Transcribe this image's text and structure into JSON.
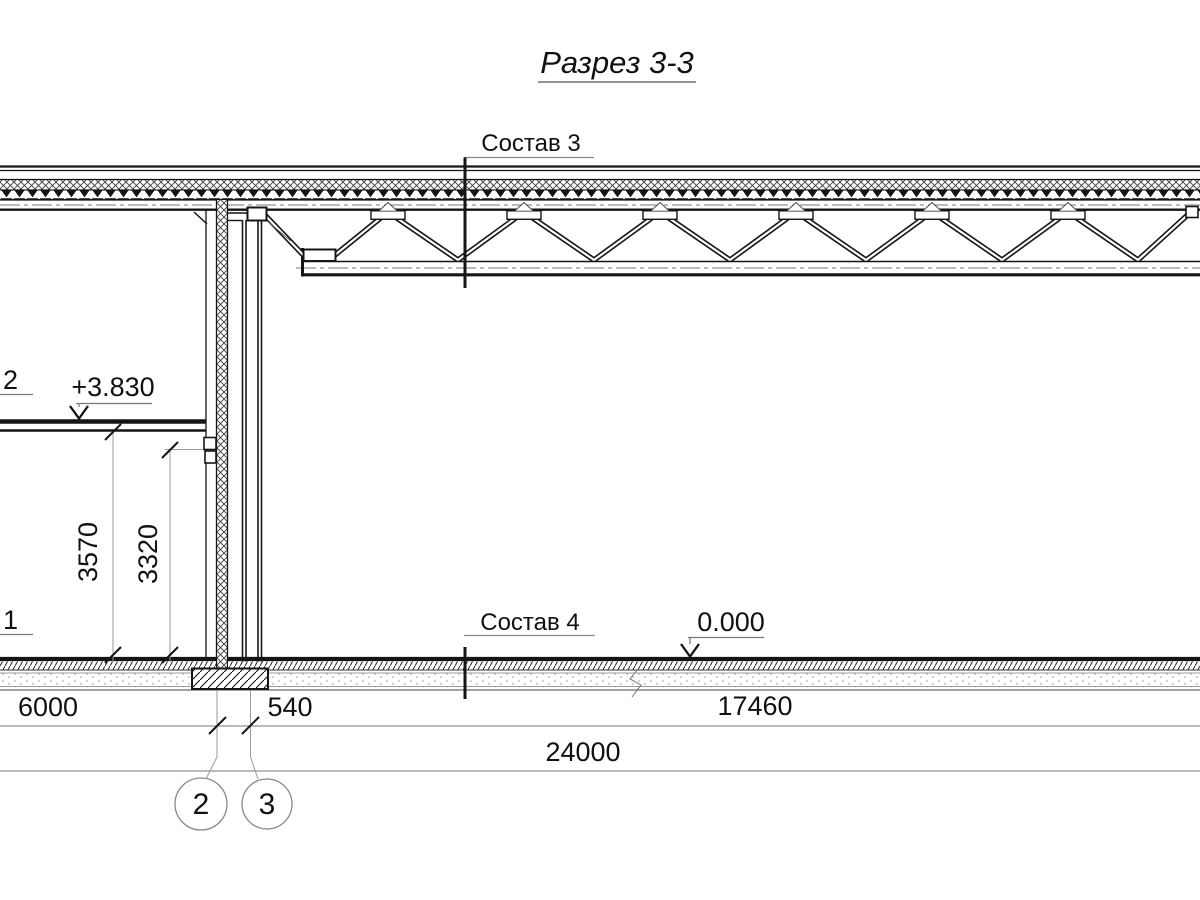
{
  "drawing": {
    "title": "Разрез 3-3",
    "type_note": "building cross-section, CAD style, black lines on white"
  },
  "callouts": {
    "roof_assembly": "Состав 3",
    "floor_assembly": "Состав 4"
  },
  "elevations": {
    "slab_level": "+3.830",
    "ground_level": "0.000"
  },
  "dimensions": {
    "room_height": "3570",
    "clear_height": "3320",
    "bay_left": "6000",
    "wall_offset": "540",
    "hall_span": "17460",
    "total_span": "24000"
  },
  "axis_labels": {
    "upper": "2",
    "lower": "1"
  },
  "grid_bubbles": {
    "axis_2": "2",
    "axis_3": "3"
  },
  "colors": {
    "line": "#151515",
    "annotation": "#777777",
    "extension": "#9a9a9a",
    "background": "#ffffff"
  }
}
